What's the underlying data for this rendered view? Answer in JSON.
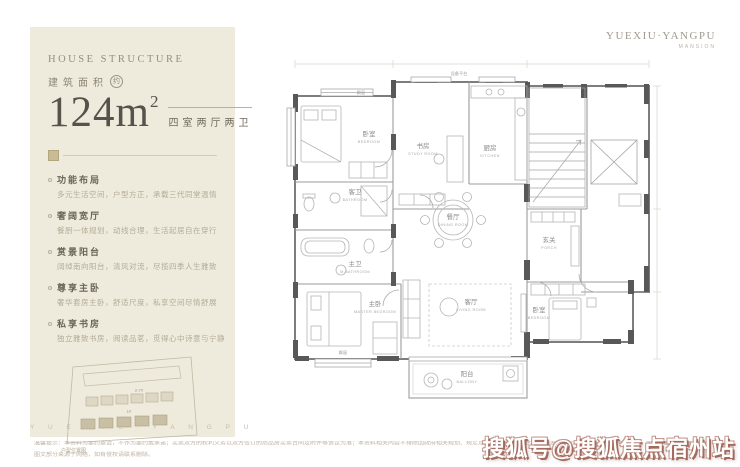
{
  "brand": {
    "logo_main": "YUEXIU·YANGPU",
    "logo_sub": "MANSION"
  },
  "panel": {
    "eyebrow": "HOUSE STRUCTURE",
    "area_label": "建筑面积",
    "area_approx": "约",
    "area_value": "124m",
    "area_sup": "2",
    "layout_tag": "四室两厅两卫",
    "features": [
      {
        "title": "功能布局",
        "desc": "多元生活空间，户型方正，承载三代同堂温情"
      },
      {
        "title": "奢阔宽厅",
        "desc": "餐厨一体规划，动线合理，生活起居自在穿行"
      },
      {
        "title": "赏景阳台",
        "desc": "阔绰南向阳台，清风对流，尽揽四季人生雅致"
      },
      {
        "title": "尊享主卧",
        "desc": "奢华套房主卧，舒适尺度，私享空间尽情舒展"
      },
      {
        "title": "私享书房",
        "desc": "独立雅致书房，阅读品茗，觅得心中诗意与宁静"
      }
    ],
    "siteplan": {
      "row1_label": "2-7#",
      "row2_label": "1#",
      "caption": "户型位置图"
    },
    "footer_letters": "Y U E X I U · Y A N G P U"
  },
  "floorplan": {
    "rooms": [
      {
        "cn": "卧室",
        "en": "BEDROOM"
      },
      {
        "cn": "书房",
        "en": "STUDY ROOM"
      },
      {
        "cn": "厨房",
        "en": "KITCHEN"
      },
      {
        "cn": "客卫",
        "en": "BATHROOM"
      },
      {
        "cn": "主卫",
        "en": "M.BATHROOM"
      },
      {
        "cn": "餐厅",
        "en": "DINING ROOM"
      },
      {
        "cn": "客厅",
        "en": "LIVING ROOM"
      },
      {
        "cn": "主卧",
        "en": "MASTER BEDROOM"
      },
      {
        "cn": "阳台",
        "en": "BALCONY"
      },
      {
        "cn": "玄关",
        "en": "PORCH"
      },
      {
        "cn": "卧室",
        "en": "BEDROOM"
      }
    ],
    "annotations": {
      "bay_window": "飘窗",
      "equipment": "设备平台"
    }
  },
  "footer": {
    "disclaimer_line1": "温馨提示：本资料为要约邀请，不作为要约或承诺；买卖双方的权利义务以双方签订的商品房买卖合同及附件等协议为准；本资料相关内容不排除因政府相关规划、规定及出卖人未能控制的原因而发生变化，出卖人保留修改的权利，敬请留意最新资料。",
    "disclaimer_line2": "图文部分来源于网络，如有侵权请联系删除。",
    "watermark": "搜狐号@搜狐焦点宿州站"
  },
  "colors": {
    "panel_bg": "#efebdc",
    "accent_tan": "#cabb97",
    "wall_gray": "#585858",
    "headline": "#55534b",
    "muted_text": "#b3ab97",
    "watermark_shadow": "#a56a5e"
  }
}
